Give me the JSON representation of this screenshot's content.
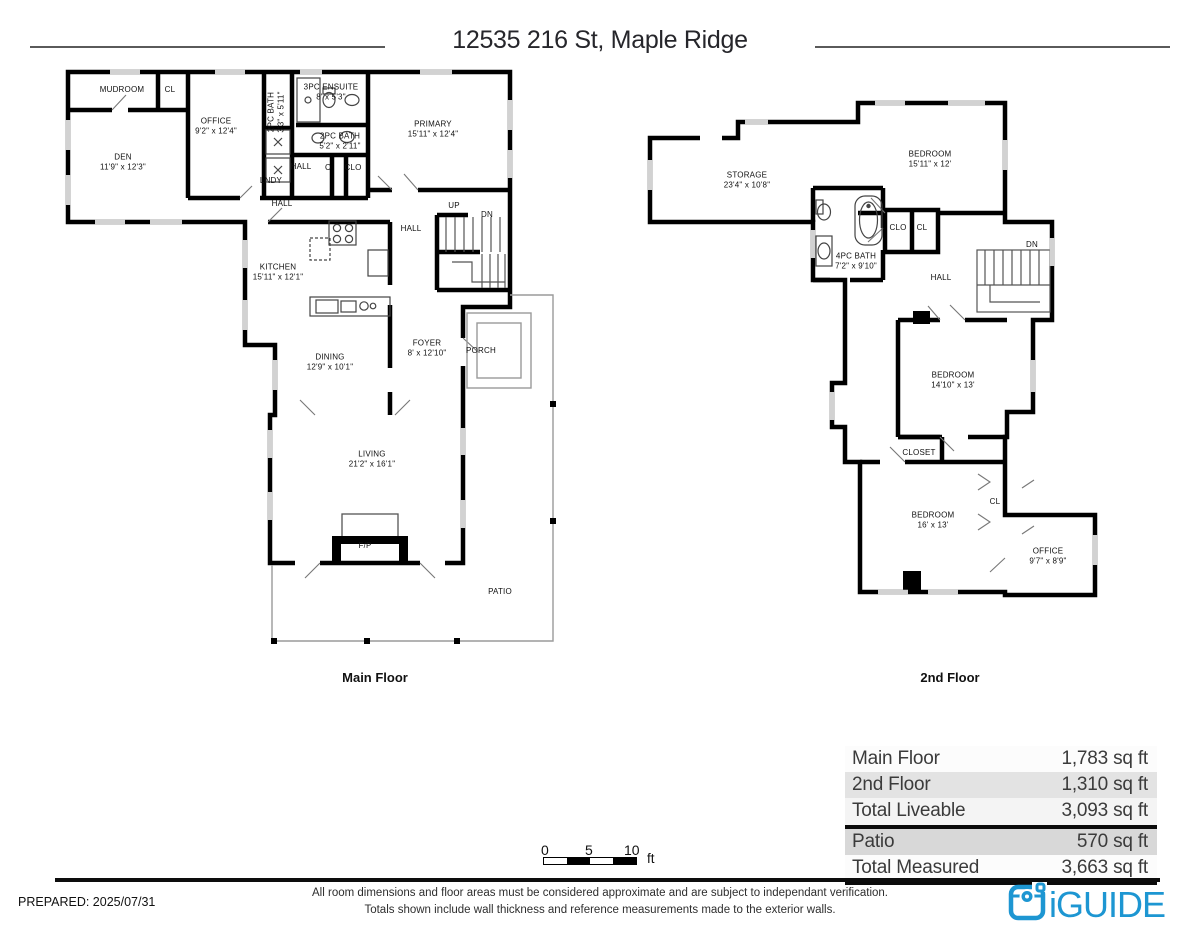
{
  "page": {
    "title": "12535 216 St, Maple Ridge"
  },
  "floors": [
    {
      "name": "Main Floor",
      "caption_x": 375,
      "caption_y": 670,
      "rooms": [
        {
          "name": "MUDROOM",
          "x": 122,
          "y": 90
        },
        {
          "name": "CL",
          "x": 170,
          "y": 90
        },
        {
          "name": "OFFICE",
          "dims": "9'2\" x 12'4\"",
          "x": 216,
          "y": 126
        },
        {
          "name": "DEN",
          "dims": "11'9\" x 12'3\"",
          "x": 123,
          "y": 162
        },
        {
          "name": "2PC BATH",
          "dims": "3'3\" x 5'11\"",
          "x": 276,
          "y": 112,
          "rot": true
        },
        {
          "name": "3PC ENSUITE",
          "dims": "8' x 5'3\"",
          "x": 331,
          "y": 92
        },
        {
          "name": "2PC BATH",
          "dims": "5'2\" x 2'11\"",
          "x": 340,
          "y": 141
        },
        {
          "name": "LNDY",
          "x": 271,
          "y": 181
        },
        {
          "name": "HALL",
          "x": 301,
          "y": 167
        },
        {
          "name": "C",
          "x": 328,
          "y": 168
        },
        {
          "name": "CLO",
          "x": 353,
          "y": 168
        },
        {
          "name": "PRIMARY",
          "dims": "15'11\" x 12'4\"",
          "x": 433,
          "y": 129
        },
        {
          "name": "HALL",
          "x": 282,
          "y": 204
        },
        {
          "name": "HALL",
          "x": 411,
          "y": 229
        },
        {
          "name": "UP",
          "x": 454,
          "y": 206
        },
        {
          "name": "DN",
          "x": 487,
          "y": 215
        },
        {
          "name": "KITCHEN",
          "dims": "15'11\" x 12'1\"",
          "x": 278,
          "y": 272
        },
        {
          "name": "DINING",
          "dims": "12'9\" x 10'1\"",
          "x": 330,
          "y": 362
        },
        {
          "name": "FOYER",
          "dims": "8' x 12'10\"",
          "x": 427,
          "y": 348
        },
        {
          "name": "PORCH",
          "x": 481,
          "y": 351
        },
        {
          "name": "LIVING",
          "dims": "21'2\" x 16'1\"",
          "x": 372,
          "y": 459
        },
        {
          "name": "F/P",
          "x": 365,
          "y": 546
        },
        {
          "name": "PATIO",
          "x": 500,
          "y": 592
        }
      ]
    },
    {
      "name": "2nd Floor",
      "caption_x": 950,
      "caption_y": 670,
      "rooms": [
        {
          "name": "STORAGE",
          "dims": "23'4\" x 10'8\"",
          "x": 747,
          "y": 180
        },
        {
          "name": "BEDROOM",
          "dims": "15'11\" x 12'",
          "x": 930,
          "y": 159
        },
        {
          "name": "4PC BATH",
          "dims": "7'2\" x 9'10\"",
          "x": 856,
          "y": 261
        },
        {
          "name": "CLO",
          "x": 898,
          "y": 228
        },
        {
          "name": "CL",
          "x": 922,
          "y": 228
        },
        {
          "name": "HALL",
          "x": 941,
          "y": 278
        },
        {
          "name": "DN",
          "x": 1032,
          "y": 245
        },
        {
          "name": "BEDROOM",
          "dims": "14'10\" x 13'",
          "x": 953,
          "y": 380
        },
        {
          "name": "CLOSET",
          "x": 919,
          "y": 453
        },
        {
          "name": "BEDROOM",
          "dims": "16' x 13'",
          "x": 933,
          "y": 520
        },
        {
          "name": "CL",
          "x": 995,
          "y": 502
        },
        {
          "name": "OFFICE",
          "dims": "9'7\" x 8'9\"",
          "x": 1048,
          "y": 556
        }
      ]
    }
  ],
  "area_table": {
    "rows": [
      {
        "label": "Main Floor",
        "value": "1,783 sq ft",
        "bg": "#fcfcfc",
        "divider": false
      },
      {
        "label": "2nd Floor",
        "value": "1,310 sq ft",
        "bg": "#e3e3e3",
        "divider": false
      },
      {
        "label": "Total Liveable",
        "value": "3,093 sq ft",
        "bg": "#f4f4f4",
        "divider": true
      },
      {
        "label": "Patio",
        "value": "570 sq ft",
        "bg": "#d8d8d8",
        "divider": false
      },
      {
        "label": "Total Measured",
        "value": "3,663 sq ft",
        "bg": "#fcfcfc",
        "divider": false
      }
    ]
  },
  "scale_bar": {
    "ticks": [
      "0",
      "5",
      "10"
    ],
    "unit": "ft"
  },
  "footer": {
    "prepared": "PREPARED: 2025/07/31",
    "disclaimer_line1": "All room dimensions and floor areas must be considered approximate and are subject to independant verification.",
    "disclaimer_line2": "Totals shown include wall thickness and reference measurements made to the exterior walls.",
    "brand": "iGUIDE"
  },
  "colors": {
    "brand_blue": "#1d96d2",
    "wall_black": "#000000",
    "window_gray": "#d2d2d2"
  }
}
